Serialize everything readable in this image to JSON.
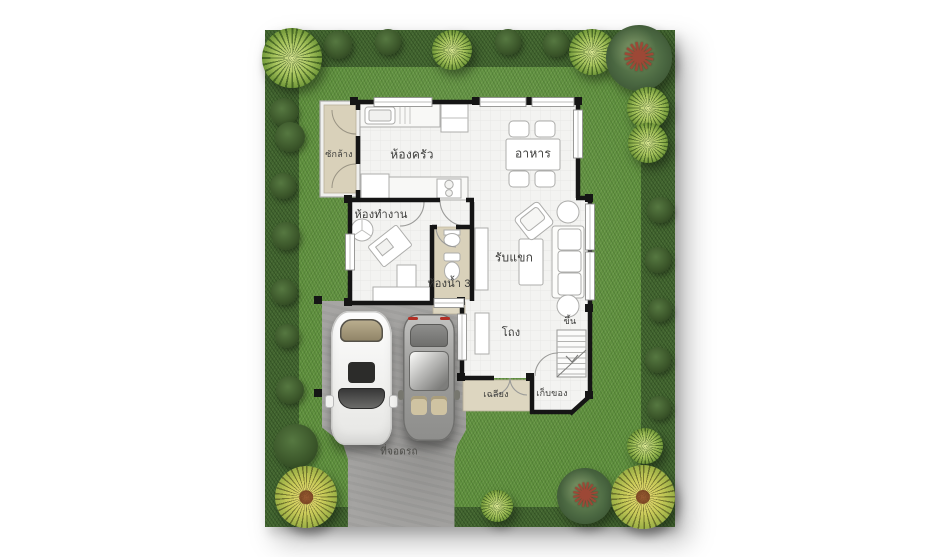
{
  "plan": {
    "rooms": {
      "laundry": {
        "label": "ซักล้าง"
      },
      "kitchen": {
        "label": "ห้องครัว"
      },
      "dining": {
        "label": "อาหาร"
      },
      "workroom": {
        "label": "ห้องทำงาน"
      },
      "bathroom": {
        "label": "ห้องน้ำ 3"
      },
      "living": {
        "label": "รับแขก"
      },
      "hall": {
        "label": "โถง"
      },
      "stairs": {
        "label": "ขึ้น"
      },
      "porch": {
        "label": "เฉลียง"
      },
      "storage": {
        "label": "เก็บของ"
      },
      "carport": {
        "label": "ที่จอดรถ"
      }
    },
    "colors": {
      "lawn": "#5e8f3d",
      "hedge": "#41642f",
      "wall": "#151515",
      "floor": "#f3f3f1",
      "beige_floor": "#d9d1ba",
      "concrete": "#a6a5a3",
      "tree_light": "#a6c35c",
      "tree_dark": "#4a6741",
      "tree_yellow": "#c9cb59",
      "branch_red": "#9d4836",
      "car_white": "#fdfdfd",
      "car_silver": "#9c9c9a"
    }
  }
}
